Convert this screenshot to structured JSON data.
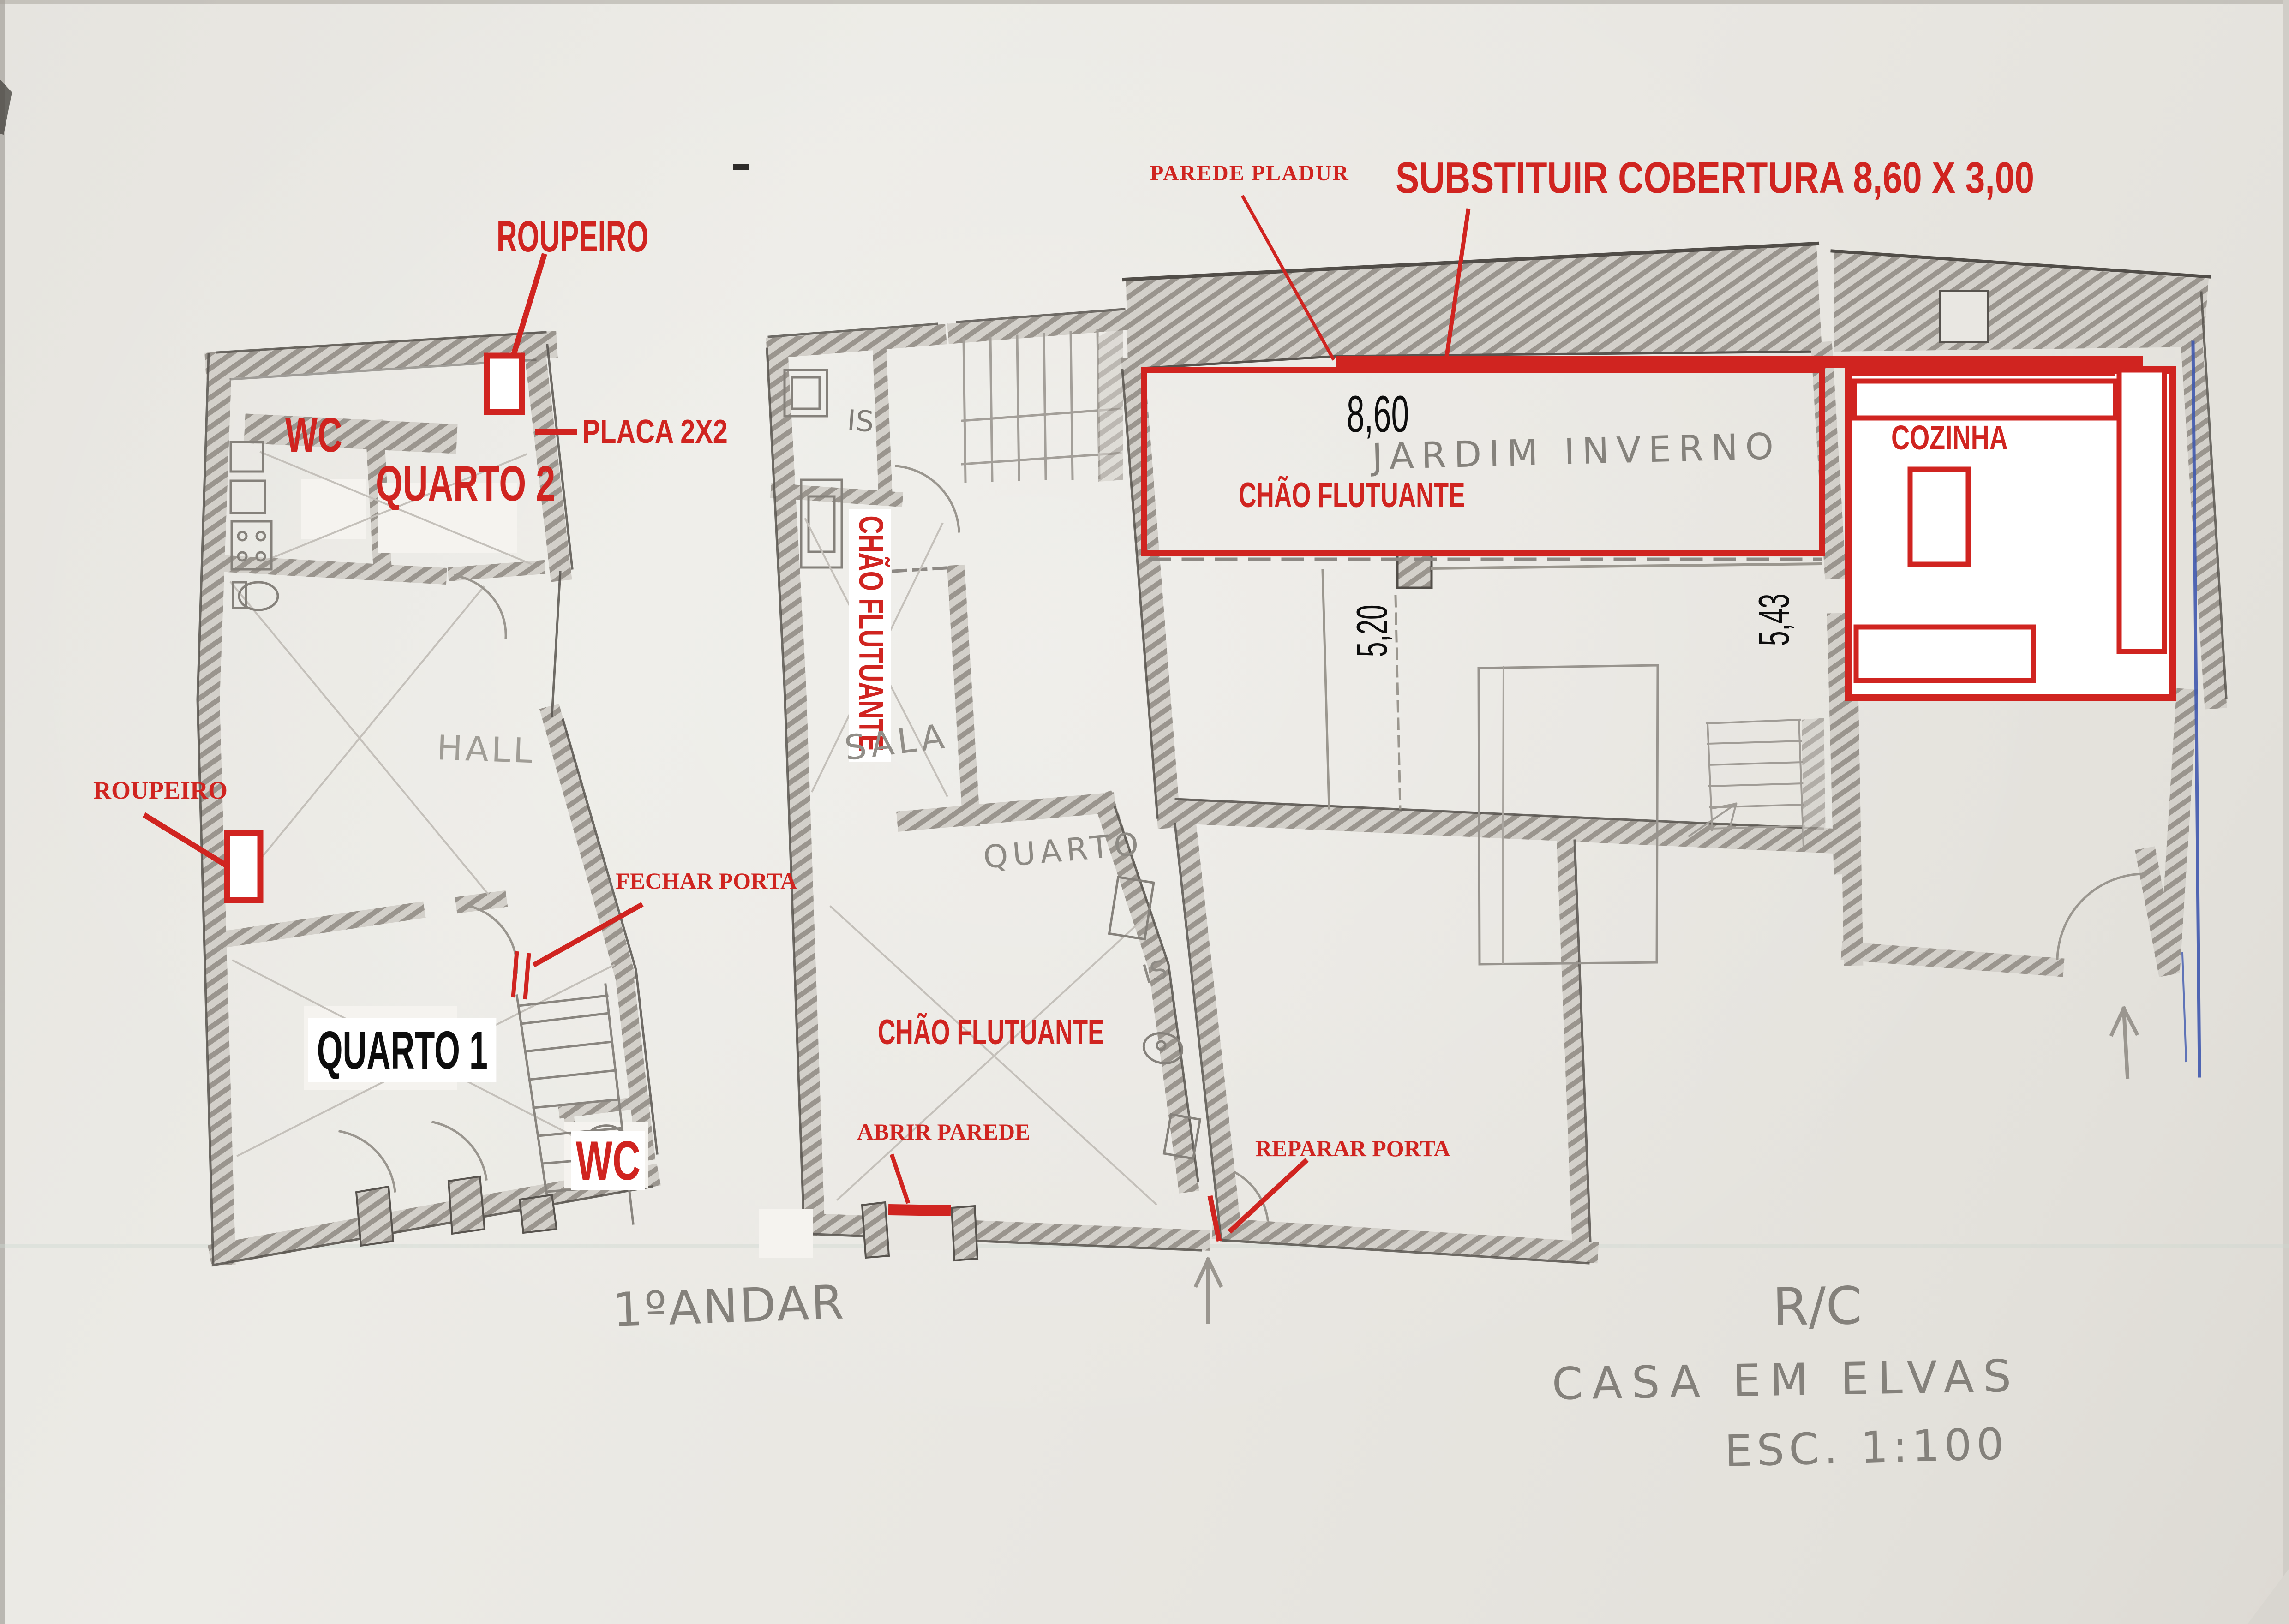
{
  "colors": {
    "annotation_red": "#d02420",
    "pencil_gray": "#8d8984",
    "ink_blue": "#3f58ae",
    "paper": "#e9e7e2",
    "black_text": "#0d0d0d"
  },
  "labels": {
    "parede_pladur": "PAREDE PLADUR",
    "substituir_cobertura": "SUBSTITUIR COBERTURA 8,60 X 3,00",
    "roupeiro_top": "ROUPEIRO",
    "placa_2x2": "PLACA 2X2",
    "wc_top": "WC",
    "quarto_2": "QUARTO 2",
    "chao_flutuante_jardim": "CHÃO FLUTUANTE",
    "cozinha": "COZINHA",
    "chao_flutuante_vertical": "CHÃO FLUTUANTE",
    "roupeiro_lower": "ROUPEIRO",
    "fechar_porta": "FECHAR PORTA",
    "chao_flutuante_lower": "CHÃO FLUTUANTE",
    "wc_lower": "WC",
    "abrir_parede": "ABRIR PAREDE",
    "reparar_porta": "REPARAR PORTA",
    "quarto_1": "QUARTO 1"
  },
  "dimensions": {
    "cobertura_width": "8,60",
    "depth_left": "5,20",
    "depth_right": "5,43"
  },
  "handwritten": {
    "jardim_inverno": "JARDIM INVERNO",
    "hall": "HALL",
    "sala": "SALA",
    "quarto": "QUARTO",
    "is_upper": "IS",
    "is_lower": "IS",
    "floor_plan_left": "1ºANDAR",
    "floor_plan_right": "R/C",
    "project_title": "CASA EM ELVAS",
    "scale_note": "ESC. 1:100"
  }
}
